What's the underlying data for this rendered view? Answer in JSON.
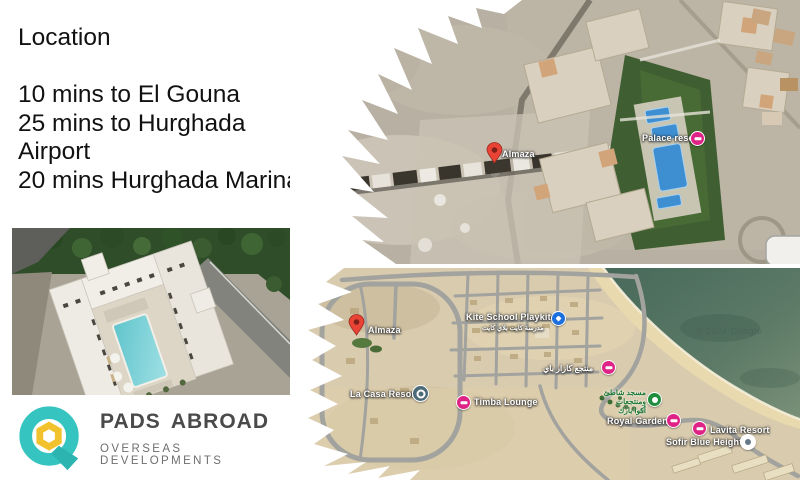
{
  "location": {
    "title": "Location",
    "line1": "10 mins to El Gouna",
    "line2": "25 mins to Hurghada Airport",
    "line3": "20 mins Hurghada Marina"
  },
  "top_map": {
    "almaza": "Almaza",
    "palace": "Palace resort"
  },
  "bottom_map": {
    "almaza": "Almaza",
    "kite": "Kite School Playkite",
    "kite_ar": "مدرسة كايت بلاي كايت",
    "lacasa": "La Casa Resort",
    "timba": "Timba Lounge",
    "bay_ar": "منتجع كازار باي",
    "green_ar1": "مسجد شاطئ",
    "green_ar2": "ومنتجعات",
    "green_ar3": "أكوا بارك",
    "royal": "Royal Gardens",
    "lavita": "Lavita Resort",
    "sofir": "Sofir Blue Heights",
    "watermark": "© 2024 Google"
  },
  "logo": {
    "name": "PADS ABROAD",
    "tagline": "OVERSEAS  DEVELOPMENTS"
  },
  "colors": {
    "accent_teal": "#35c4bf",
    "accent_yellow": "#f2c12e",
    "pin_red": "#e94335",
    "poi_pink": "#df2286",
    "poi_blue": "#1d6fdc",
    "poi_green": "#1e8e3e",
    "sea_green": "#5c7a66",
    "pool_blue": "#66cdd3"
  }
}
